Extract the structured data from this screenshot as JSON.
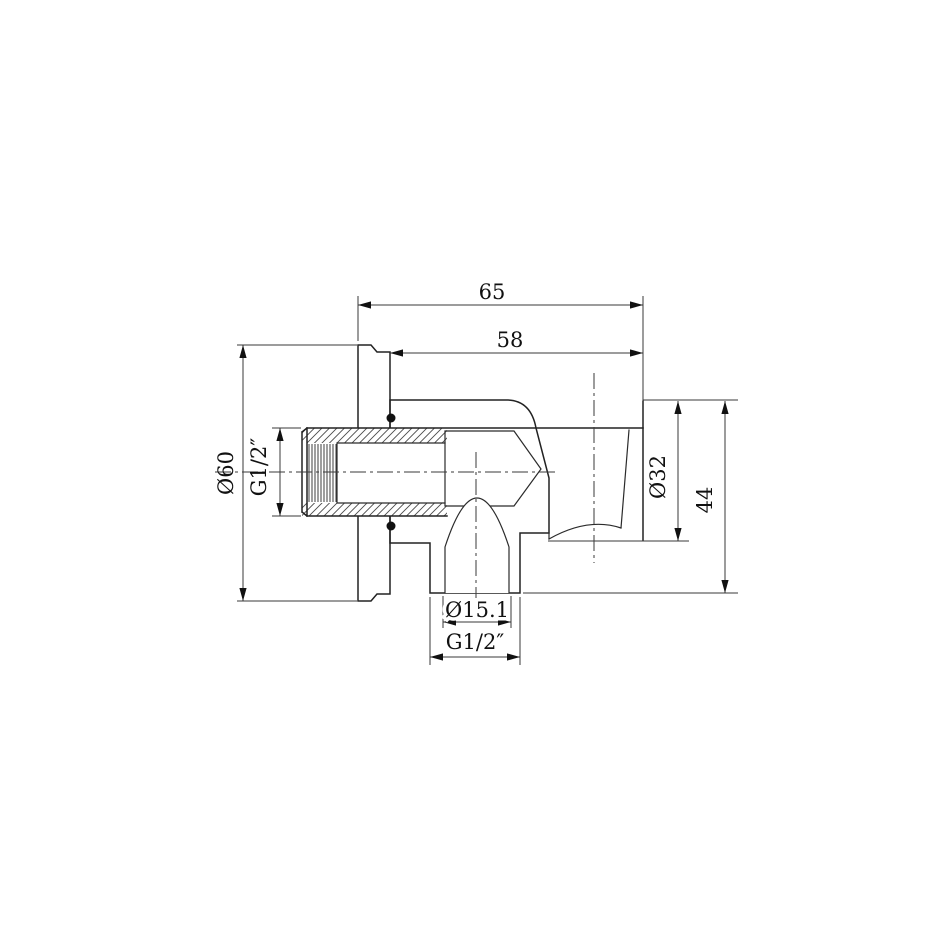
{
  "drawing": {
    "background_color": "#ffffff",
    "line_color": "#222222",
    "type_label": "sectioned technical drawing of shower wall outlet elbow with handset holder",
    "dimensions": {
      "overall_depth": {
        "label": "65"
      },
      "body_depth": {
        "label": "58"
      },
      "flange_diameter": {
        "label": "Ø60"
      },
      "inlet_thread": {
        "label": "G1/2″"
      },
      "holder_diameter": {
        "label": "Ø32"
      },
      "holder_height": {
        "label": "44"
      },
      "outlet_bore_diameter": {
        "label": "Ø15.1"
      },
      "outlet_thread": {
        "label": "G1/2″"
      }
    }
  }
}
